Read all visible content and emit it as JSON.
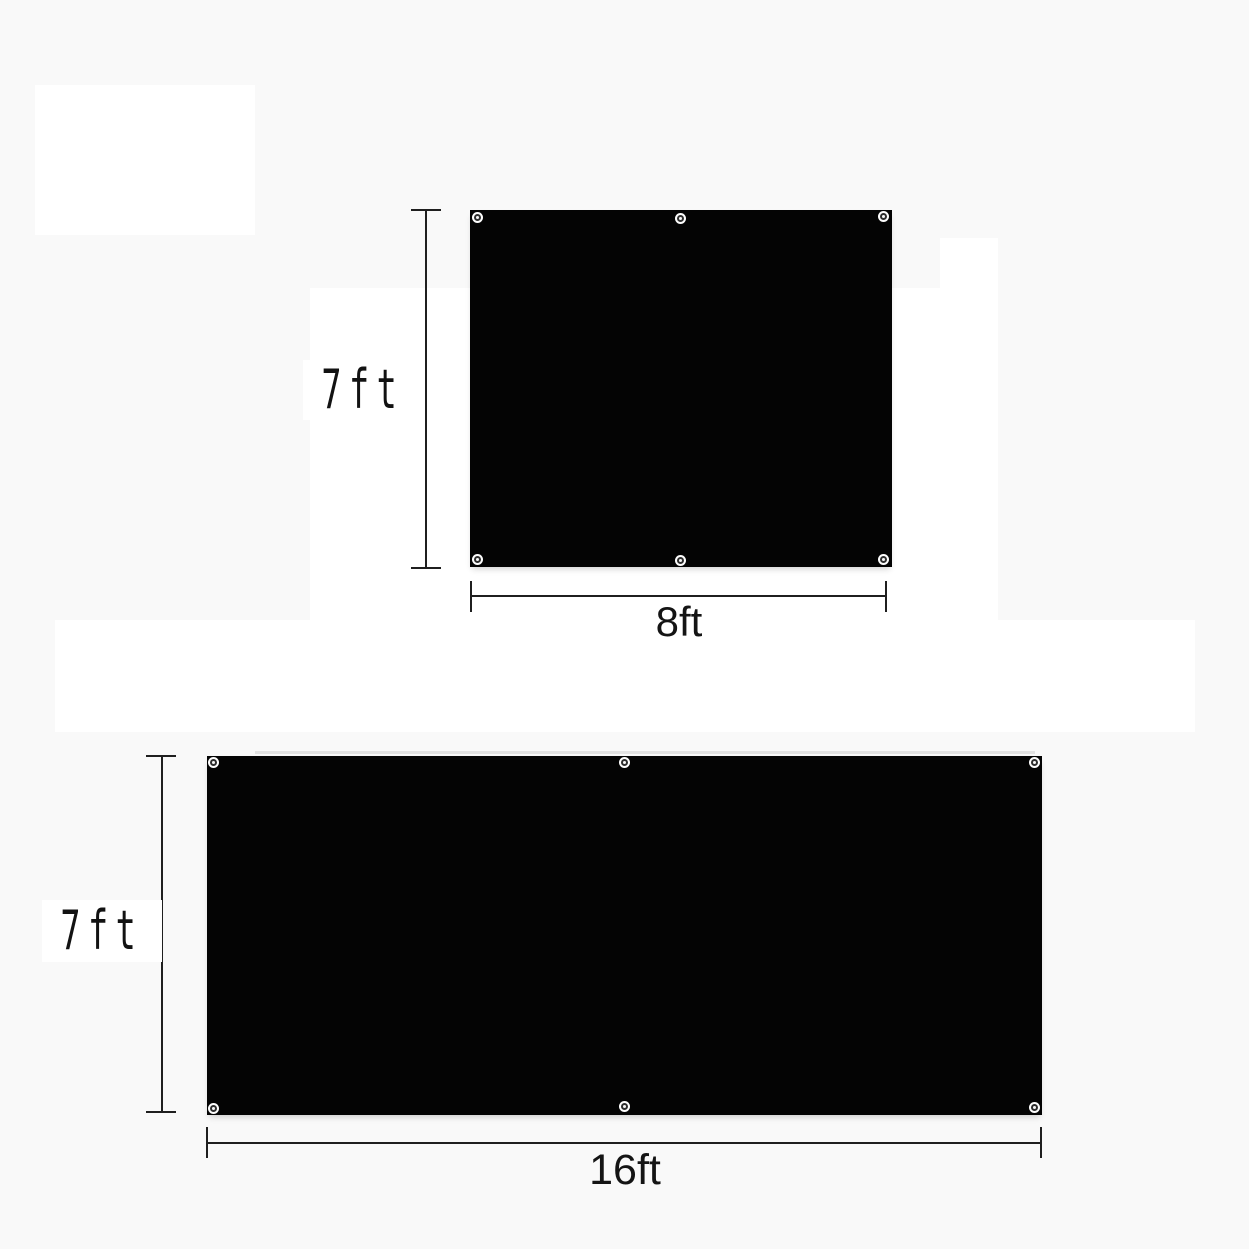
{
  "image_type": "product-dimension-diagram",
  "colors": {
    "background": "#f9f9f9",
    "panel_fabric": "#040404",
    "dimension_line": "#1f1f1f",
    "label_text": "#141414",
    "label_box_background": "#ffffff"
  },
  "figures": [
    {
      "id": "panel-8ft-by-7ft",
      "height_label": "7ft",
      "width_label": "8ft",
      "grommet_count": 6
    },
    {
      "id": "panel-16ft-by-7ft",
      "height_label": "7ft",
      "width_label": "16ft",
      "grommet_count": 6
    }
  ]
}
